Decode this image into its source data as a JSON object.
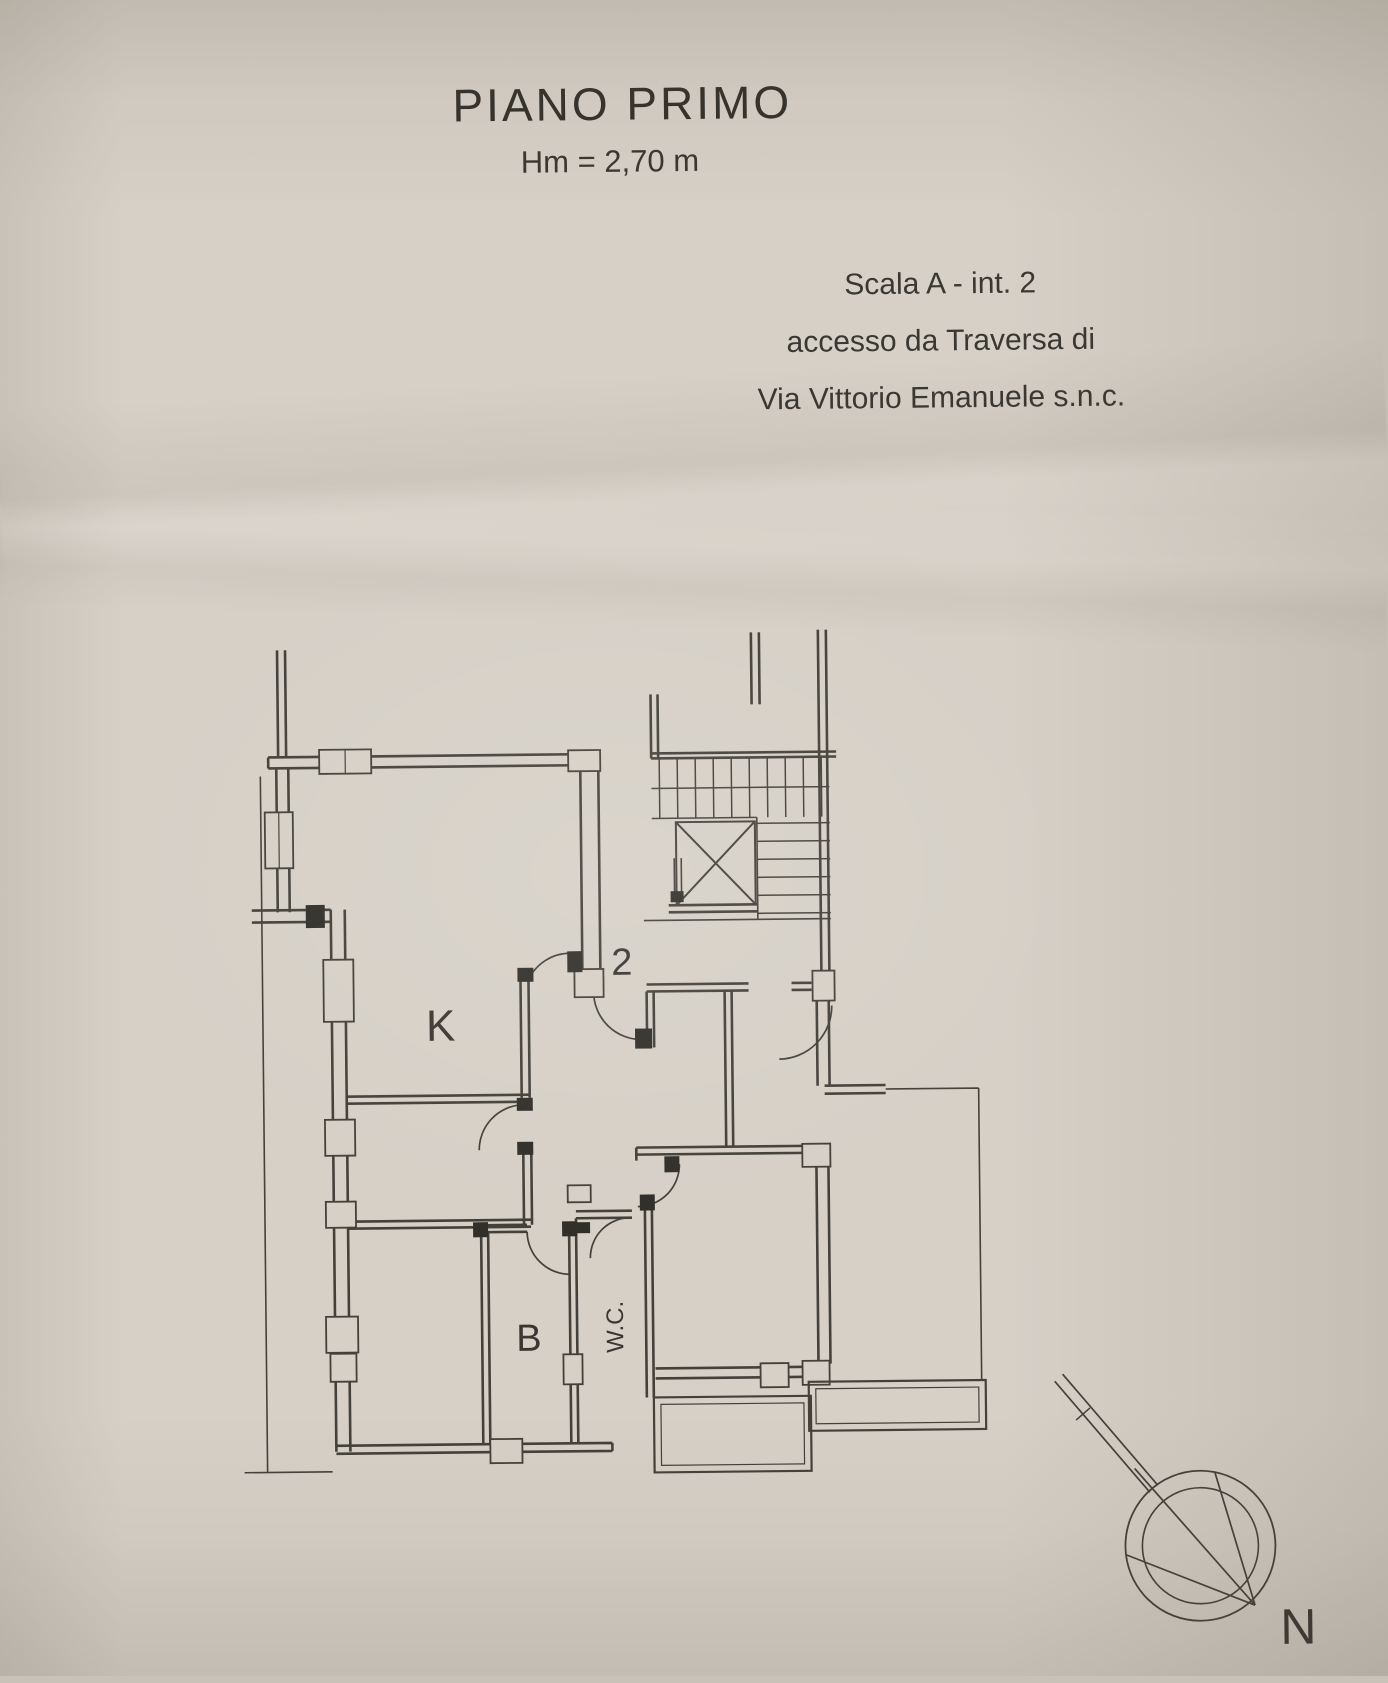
{
  "header": {
    "title": "PIANO PRIMO",
    "subtitle": "Hm = 2,70 m"
  },
  "access": {
    "line1": "Scala A - int. 2",
    "line2": "accesso da Traversa di",
    "line3": "Via Vittorio Emanuele s.n.c."
  },
  "plan": {
    "labels": {
      "unit": "2",
      "kitchen": "K",
      "bath": "B",
      "wc": "W.C."
    }
  },
  "compass": {
    "north": "N"
  },
  "colors": {
    "paper": "#d6d0c7",
    "ink": "#44413a"
  }
}
